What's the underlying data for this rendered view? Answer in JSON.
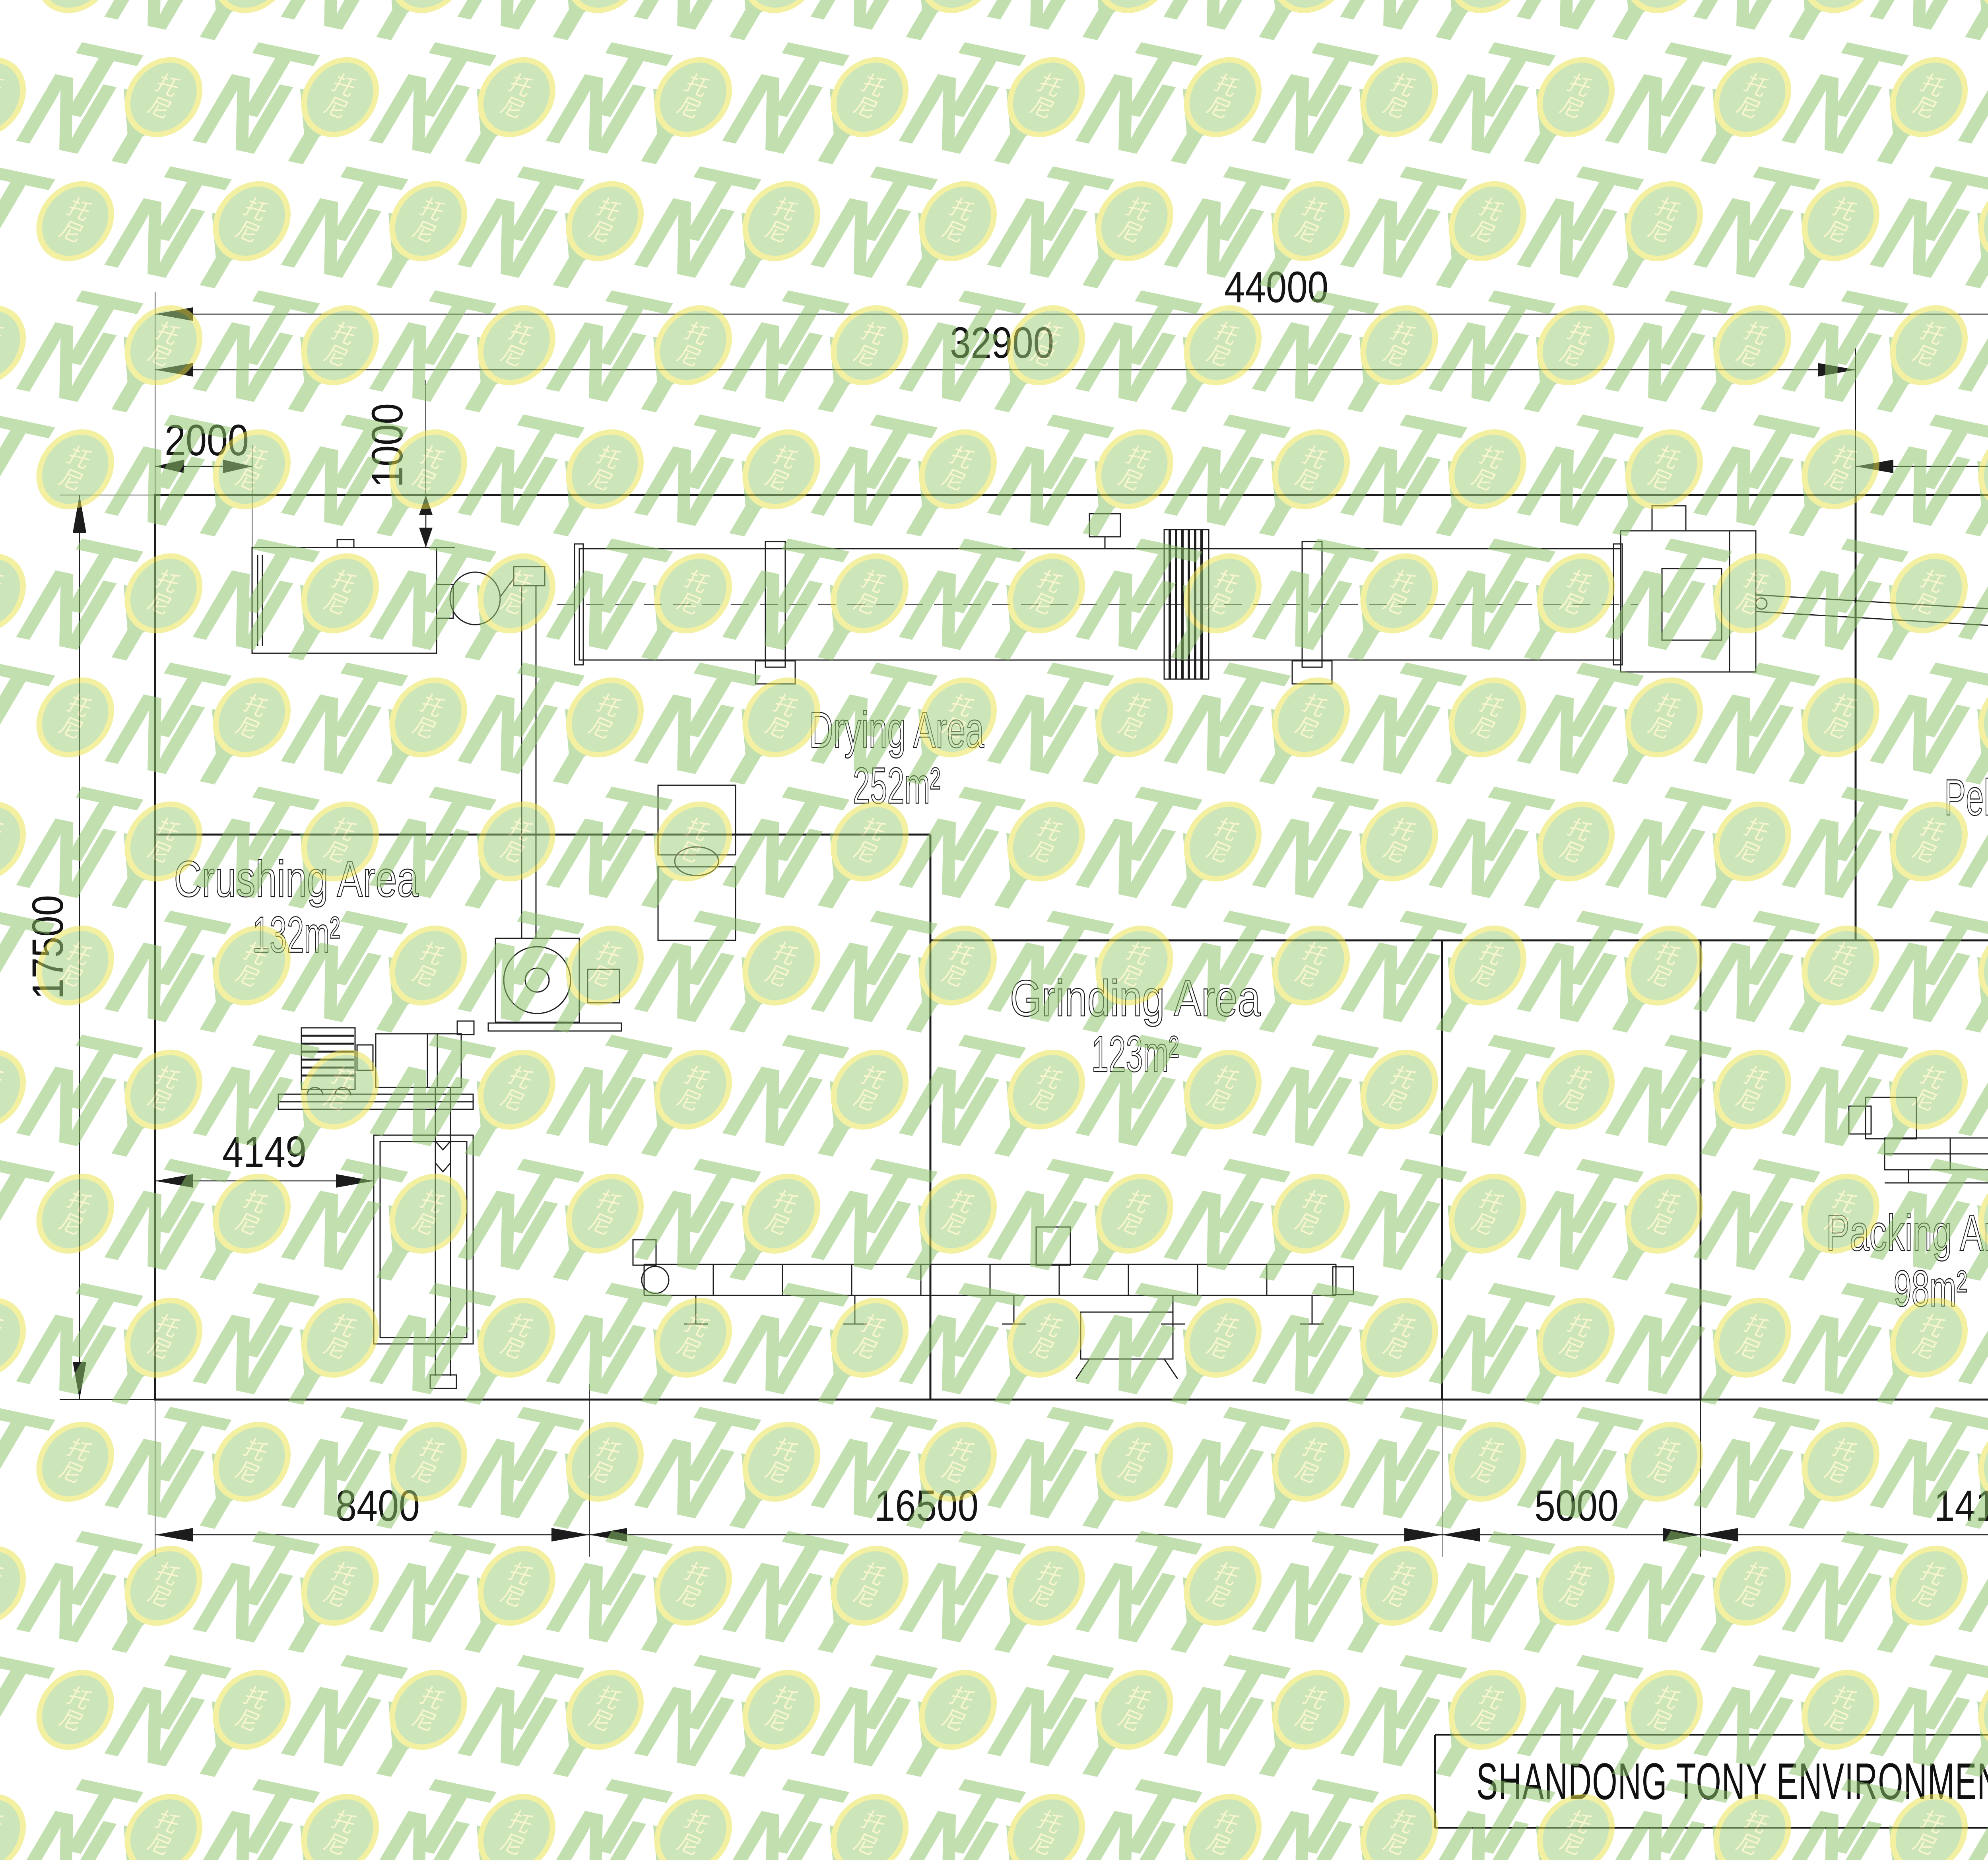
{
  "watermark": {
    "prefix": "T",
    "suffix": "NY",
    "seal_top": "托",
    "seal_bottom": "尼"
  },
  "areas": [
    {
      "name": "Drying Area",
      "area": "252m²"
    },
    {
      "name": "Crushing Area",
      "area": "132m²"
    },
    {
      "name": "Grinding Area",
      "area": "123m²"
    },
    {
      "name": "Pelleting&Cooling Area",
      "area": "121m²"
    },
    {
      "name": "Packing Area",
      "area": "98m²"
    }
  ],
  "dimensions": {
    "overall_width": "44000",
    "drying_section_width": "32900",
    "left_wall_offset": "2000",
    "feeder_offset": "1000",
    "pelleting_section_width": "11100",
    "building_depth": "17500",
    "pelleting_depth": "8500",
    "packing_depth": "9000",
    "bay_crushing": "8400",
    "bay_grinding": "16500",
    "bay_corridor": "5000",
    "bay_packing": "14100",
    "crusher_offset": "4149",
    "packing_line_length": "6041"
  },
  "title_block": {
    "company": "SHANDONG TONY ENVIRONMENTAL PROTECTION SCI-TECH CO.,LTD"
  },
  "colors": {
    "watermark_green": "#8cc468",
    "watermark_yellow": "#e9e44f",
    "watermark_fill": "#9ecf7b",
    "seal_text": "#f2eda8",
    "line_color": "#1c1c1c"
  }
}
